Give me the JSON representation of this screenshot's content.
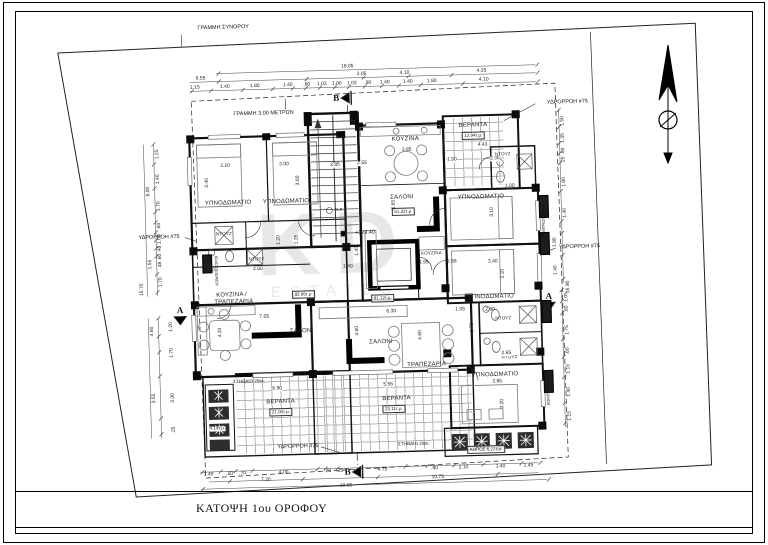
{
  "sheet": {
    "title": "ΚΑΤΟΨΗ 1ου ΟΡΟΦΟΥ"
  },
  "annotations": {
    "boundary_line": "ΓΡΑΜΜΗ ΣΥΝΟΡΟΥ",
    "setback_line": "ΓΡΑΜΜΗ 3.00 ΜΕΤΡΩΝ",
    "downspout": "ΥΔΡΟΡΡΟΗ #75",
    "parapet": "ΣΤΗΘΑΙΟ 20εκ.",
    "garden": "ΚΗΠΟΣ 6.22τ.μ.",
    "planter_area": "4.14τ.μ.",
    "elevation": "+129.40",
    "exit_abbrev": "Χ.Α.",
    "compressors": "ΚΟΜΠΡΕΣΟΡΟΙ",
    "section_a": "A",
    "section_b": "B"
  },
  "watermark": {
    "line1": "KD",
    "line2": "ESTATES"
  },
  "rooms": {
    "bedroom": "ΥΠΝΟΔΩΜΑΤΙΟ",
    "kitchen": "ΚΟΥΖΙΝΑ",
    "kitchen_dining_l1": "ΚΟΥΖΙΝΑ /",
    "kitchen_dining_l2": "ΤΡΑΠΕΖΑΡΙΑ",
    "salon": "ΣΑΛΟΝΙ",
    "dining": "ΤΡΑΠΕΖΑΡΙΑ",
    "veranda": "ΒΕΡΑΝΤΑ",
    "shower": "ΝΤΟΥΖ"
  },
  "areas": {
    "apt_left": "82.86τ.μ.",
    "apt_mid": "51.32τ.μ.",
    "apt_bottom": "81.12τ.μ.",
    "veranda_tr": "12.94τ.μ.",
    "veranda_bl": "21.00τ.μ.",
    "veranda_bm": "23.11τ.μ."
  },
  "dims": {
    "top_total": "18.05",
    "top_major": [
      "6.55",
      "3.05",
      "4.10",
      "4.35"
    ],
    "top_minor": [
      "1.15",
      "1.40",
      "1.80",
      "1.40",
      ".80",
      "1.03",
      "1.00",
      "1.03",
      ".90",
      "1.40",
      "1.40",
      "1.80",
      "4.10"
    ],
    "bottom_minor": [
      "1.40",
      ".50",
      ".70",
      "4.00",
      ".70",
      ".25",
      "4.75",
      ".80",
      "2.10",
      "1.40",
      "1.45"
    ],
    "bottom_mid": [
      "7.30",
      "10.75"
    ],
    "bottom_total": "18.05",
    "left": [
      "1.25",
      "1.40",
      "1.70",
      ".60",
      "1.05",
      ".48",
      ".60",
      ".48",
      "1.70"
    ],
    "left_totals": [
      "6.00",
      "1.55",
      "15.70"
    ],
    "left_lower": [
      "4.60",
      "1.20",
      "1.70",
      "3.30",
      "3.55",
      ".25"
    ],
    "right": [
      "1.50",
      "1.35",
      ".60",
      ".25",
      "1.80",
      "1.40",
      "1.90",
      "1.40"
    ],
    "right_totals": [
      "5.10",
      "16.90"
    ],
    "right_lower": [
      "1.05",
      ".60",
      "1.75",
      ".60",
      "1.15",
      "1.40",
      "1.15"
    ],
    "interior": [
      "3.20",
      "3.40",
      "3.00",
      "3.60",
      "2.85",
      "3.85",
      "6.65",
      "1.90",
      "2.35",
      "4.43",
      "1.00",
      "3.10",
      "3.40",
      "3.10",
      "2.50",
      "1.20",
      "1.35",
      "1.90",
      "1.45",
      "1.40",
      "1.95",
      "2.68",
      "7.05",
      "4.10",
      "5.90",
      "6.30",
      "1.05",
      "4.60",
      "4.60",
      "5.55",
      "3.85",
      "3.20",
      "2.60",
      "1.70",
      "2.65",
      "1.90",
      "2.55"
    ]
  }
}
